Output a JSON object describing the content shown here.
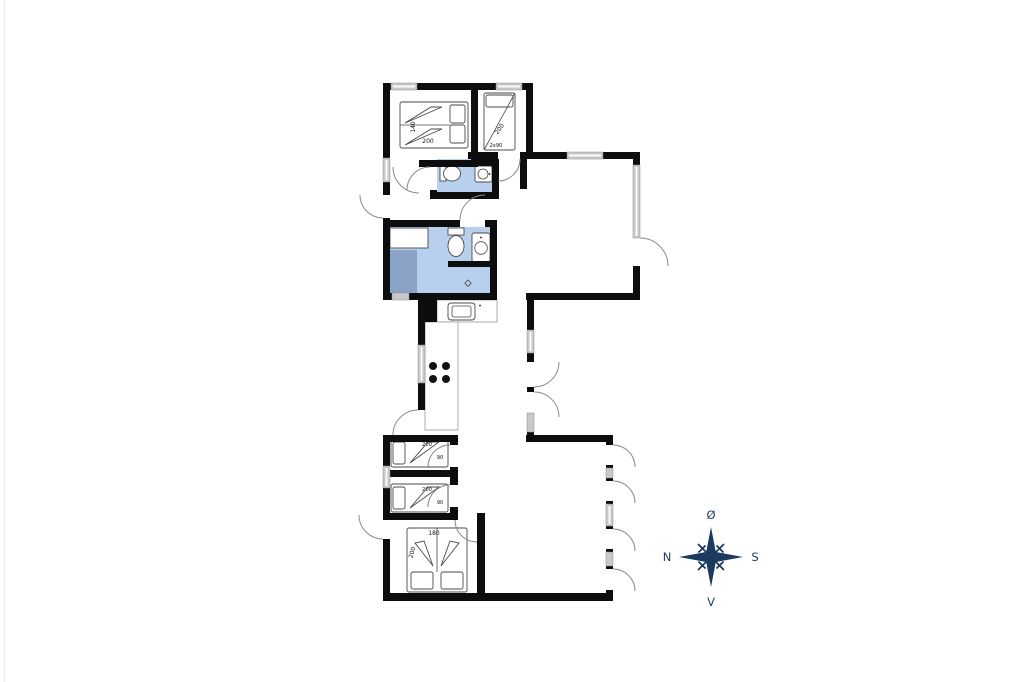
{
  "floorplan": {
    "colors": {
      "wall": "#0d0d0d",
      "window": "#c9c9c9",
      "bathroom_floor": "#b8cfee",
      "shower_floor": "#89a2c6",
      "door_arc": "#8a8a8a",
      "compass": "#1b3a5f"
    },
    "bedrooms": {
      "north_double": {
        "bed_width": "140",
        "bed_length": "200"
      },
      "north_bunk": {
        "bed_length": "200",
        "bed_width": "2x90"
      },
      "middle_single_1": {
        "bed_length": "200",
        "bed_width": "90"
      },
      "middle_single_2": {
        "bed_length": "200",
        "bed_width": "90"
      },
      "south_double": {
        "bed_width": "180",
        "bed_length": "200"
      }
    },
    "compass": {
      "top": "Ø",
      "right": "S",
      "bottom": "V",
      "left": "N"
    }
  }
}
